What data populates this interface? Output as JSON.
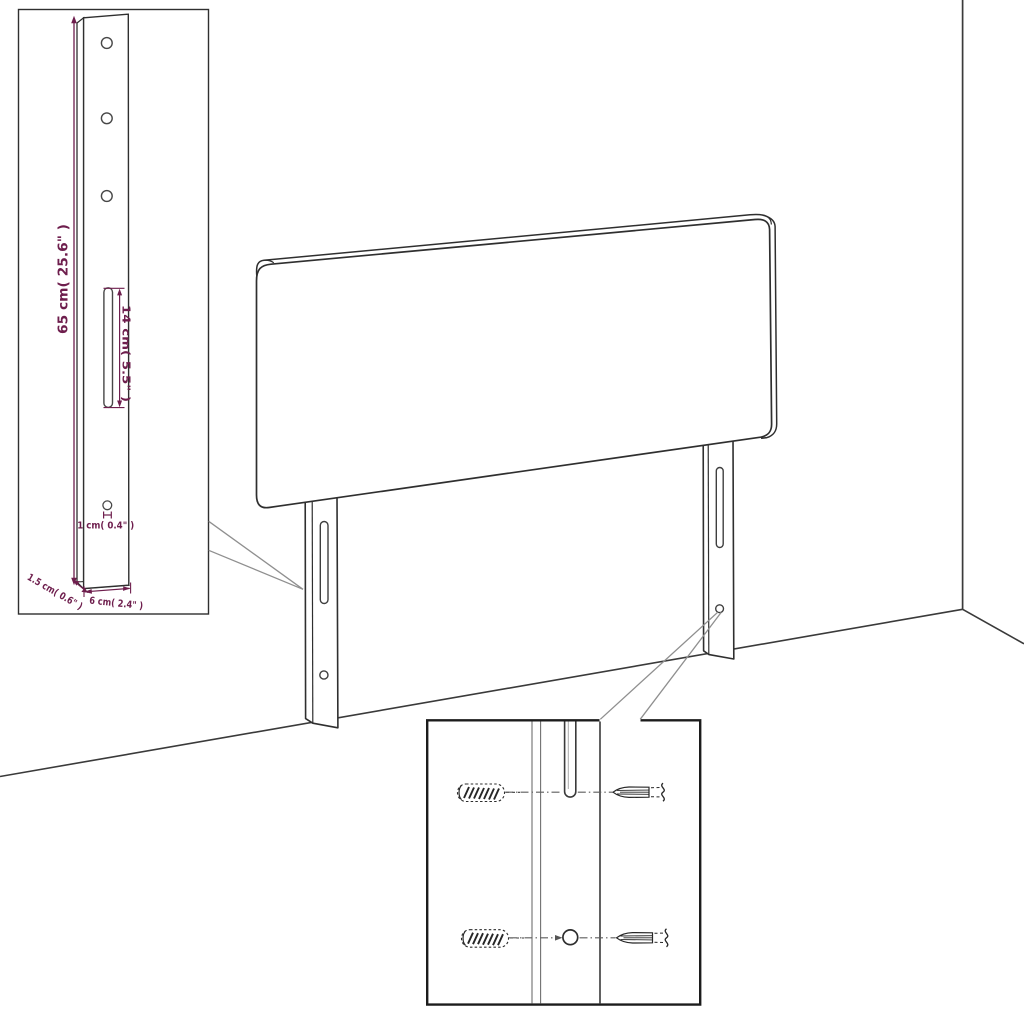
{
  "page": {
    "title": "Headboard with legs - dimension diagram",
    "background": "#ffffff"
  },
  "colors": {
    "outline": "#2f2f2f",
    "detail_outline": "#474747",
    "dimension": "#6e1e4d",
    "pointer": "#8f8f8f",
    "room_line": "#3a3a3a"
  },
  "insets": {
    "leg_detail": {
      "labels": {
        "height": "65 cm( 25.6\" )",
        "slot_height": "14 cm( 5.5\" )",
        "hole_diameter": "1 cm( 0.4\" )",
        "depth": "1.5 cm( 0.6\" )",
        "width": "6 cm( 2.4\" )"
      },
      "icons": {
        "holes": "mounting-hole-icon",
        "slot": "keyhole-slot-icon"
      }
    },
    "mounting_detail": {
      "icons": {
        "wall_plug": "wall-plug-icon",
        "screw": "screw-icon",
        "slot": "keyhole-slot-icon",
        "hole": "mounting-hole-icon"
      }
    }
  }
}
